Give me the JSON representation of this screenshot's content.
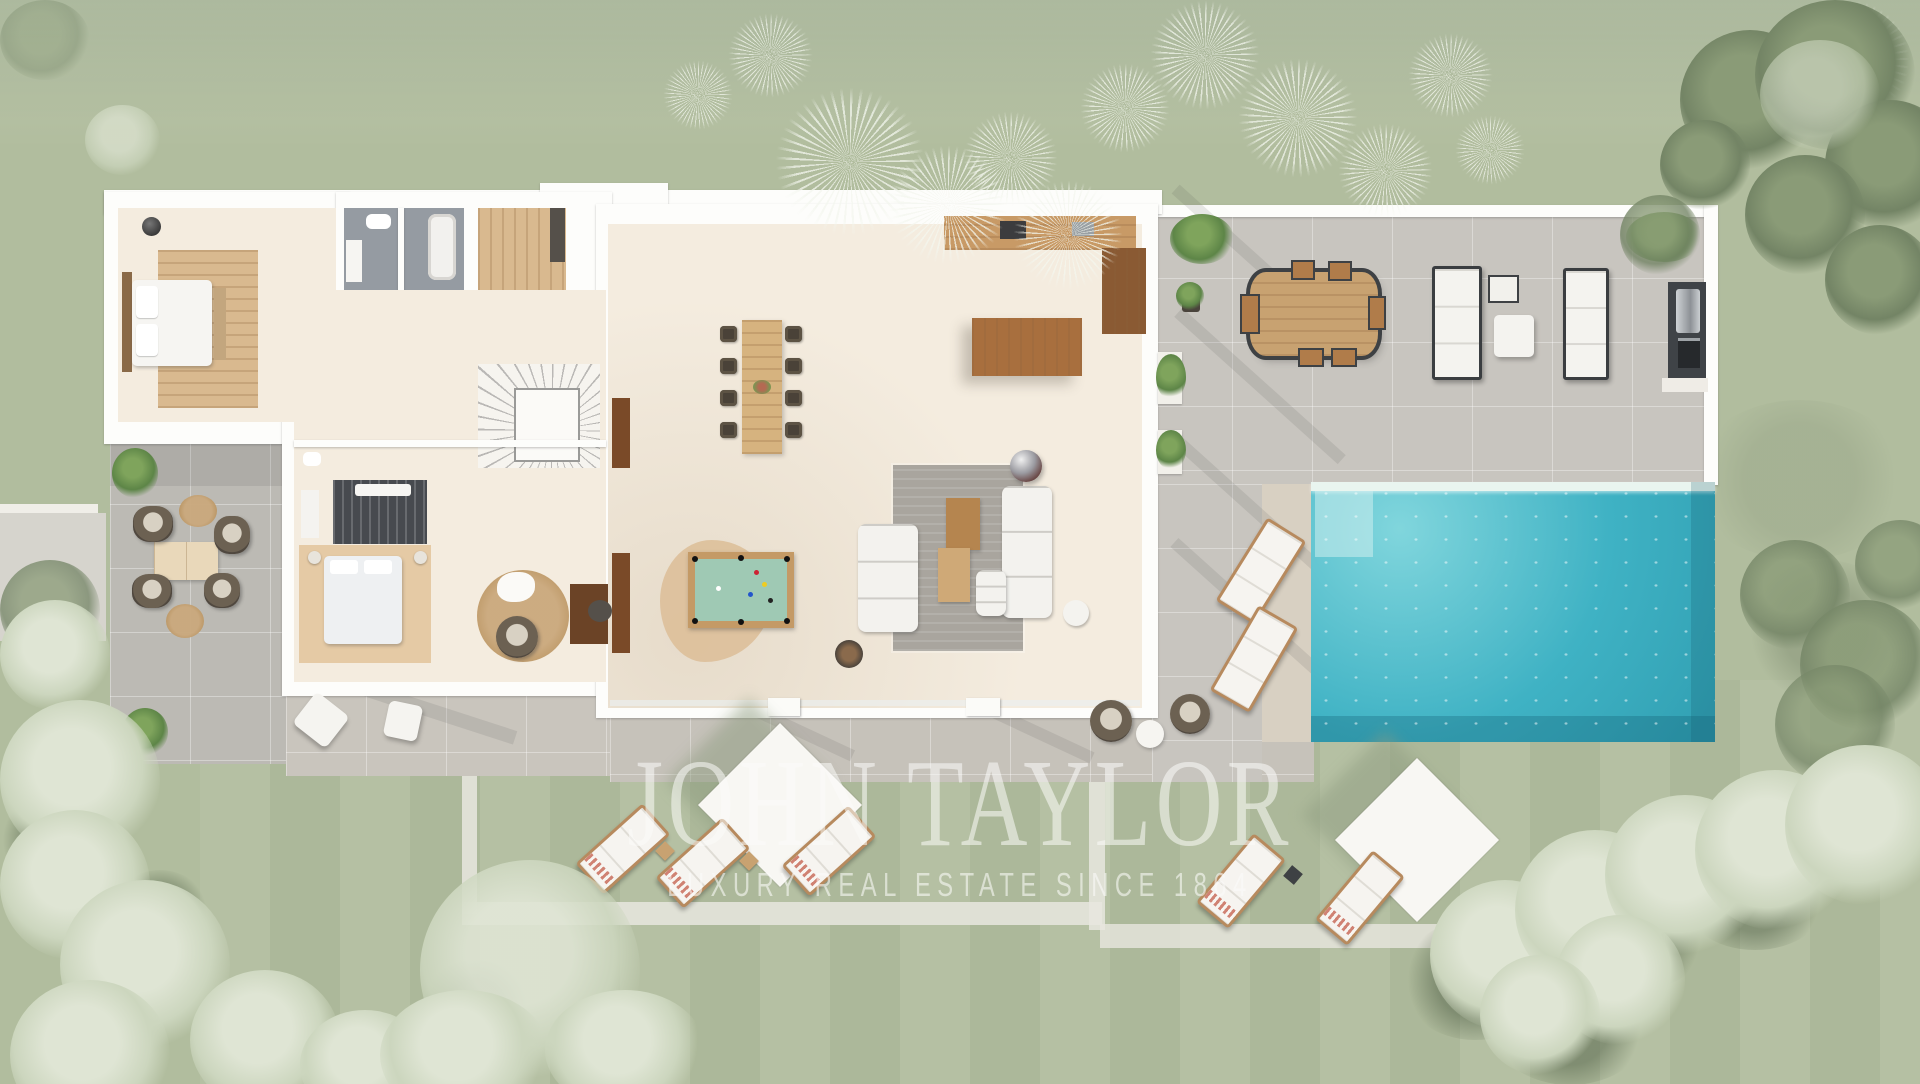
{
  "image": {
    "kind": "aerial-3d-floor-plan-render",
    "description": "Top-down 3D rendering of a single-storey luxury villa with interior furniture, surrounding stone terraces, swimming pool, lawn, pathways and olive/palm trees"
  },
  "watermark": {
    "title": "JOHN TAYLOR",
    "subtitle": "LUXURY REAL ESTATE SINCE 1864",
    "subtitle_visible": "LUXURY REAL ESTATE SINCE 186"
  },
  "palette": {
    "grass": "#b1bd9e",
    "grass_shadow": "#8fa07e",
    "tree_pale": "#dfe5d4",
    "tree_dark": "#738465",
    "wall_white": "#fdfdfb",
    "floor_cream": "#f4ecdf",
    "wood_light": "#d9b98f",
    "wood_mid": "#c89a66",
    "wood_dark": "#8a5a33",
    "terrace_gray": "#c8c5bf",
    "patio_gray": "#bcbab4",
    "pool_water": "#3fb2c4",
    "pool_waterline": "#e9f5ef",
    "billiard_felt": "#9fc9b4",
    "watermark_white": "rgba(251,252,249,0.55)"
  },
  "scene": {
    "house_rooms": [
      {
        "name": "master-bedroom",
        "items": [
          "double-bed",
          "wood-deck-rug",
          "bench",
          "round-ceiling-light"
        ]
      },
      {
        "name": "master-bathrooms",
        "items": [
          "toilet",
          "vanity",
          "bathtub",
          "sink"
        ]
      },
      {
        "name": "dressing-closet",
        "items": [
          "wood-floor",
          "dark-wardrobe"
        ]
      },
      {
        "name": "hallway",
        "items": []
      },
      {
        "name": "staircase",
        "items": [
          "radial-steps",
          "white-core"
        ]
      },
      {
        "name": "guest-bedroom",
        "items": [
          "double-bed",
          "tan-rug",
          "two-stools",
          "slatted-wardrobe",
          "white-bench",
          "ensuite-sink",
          "ensuite-toilet"
        ]
      },
      {
        "name": "reading-nook",
        "items": [
          "round-jute-rug",
          "rattan-armchair",
          "white-throw"
        ]
      },
      {
        "name": "study",
        "items": [
          "desk",
          "desk-chair",
          "sideboards"
        ]
      },
      {
        "name": "games-area",
        "items": [
          "billiard-table",
          "cowhide-rug"
        ]
      },
      {
        "name": "great-room",
        "items": [
          "dining-table",
          "8-dining-chairs",
          "kitchen-wall-counter",
          "kitchen-island",
          "tall-cabinet",
          "two-white-sofas",
          "gray-area-rug",
          "two-coffee-tables",
          "hanging-fireplace-orb",
          "round-side-tables"
        ]
      }
    ],
    "outdoor": [
      {
        "name": "left-patio",
        "items": [
          "4-rattan-armchairs",
          "square-coffee-table",
          "2-round-jute-rugs",
          "2-shrubs"
        ]
      },
      {
        "name": "south-terrace",
        "items": [
          "2-white-poufs",
          "2-rattan-chairs",
          "round-white-table"
        ]
      },
      {
        "name": "pool-terrace",
        "items": [
          "outdoor-dining-table",
          "6-seats",
          "2-sun-loungers",
          "side-table",
          "ottoman",
          "outdoor-kitchen-bbq",
          "planter-boxes",
          "shrubs"
        ]
      },
      {
        "name": "pool-side",
        "items": [
          "2-tilted-sun-loungers"
        ]
      },
      {
        "name": "garden",
        "items": [
          "2-white-shade-canopies",
          "5-sun-loungers-with-striped-towels",
          "white-pathways",
          "olive-trees",
          "palm-trees",
          "lawn"
        ]
      }
    ],
    "pool": {
      "shape": "rectangle",
      "features": [
        "waterline-mosaic-band",
        "tanning-shelf-top-left",
        "sparkling-water"
      ]
    }
  }
}
